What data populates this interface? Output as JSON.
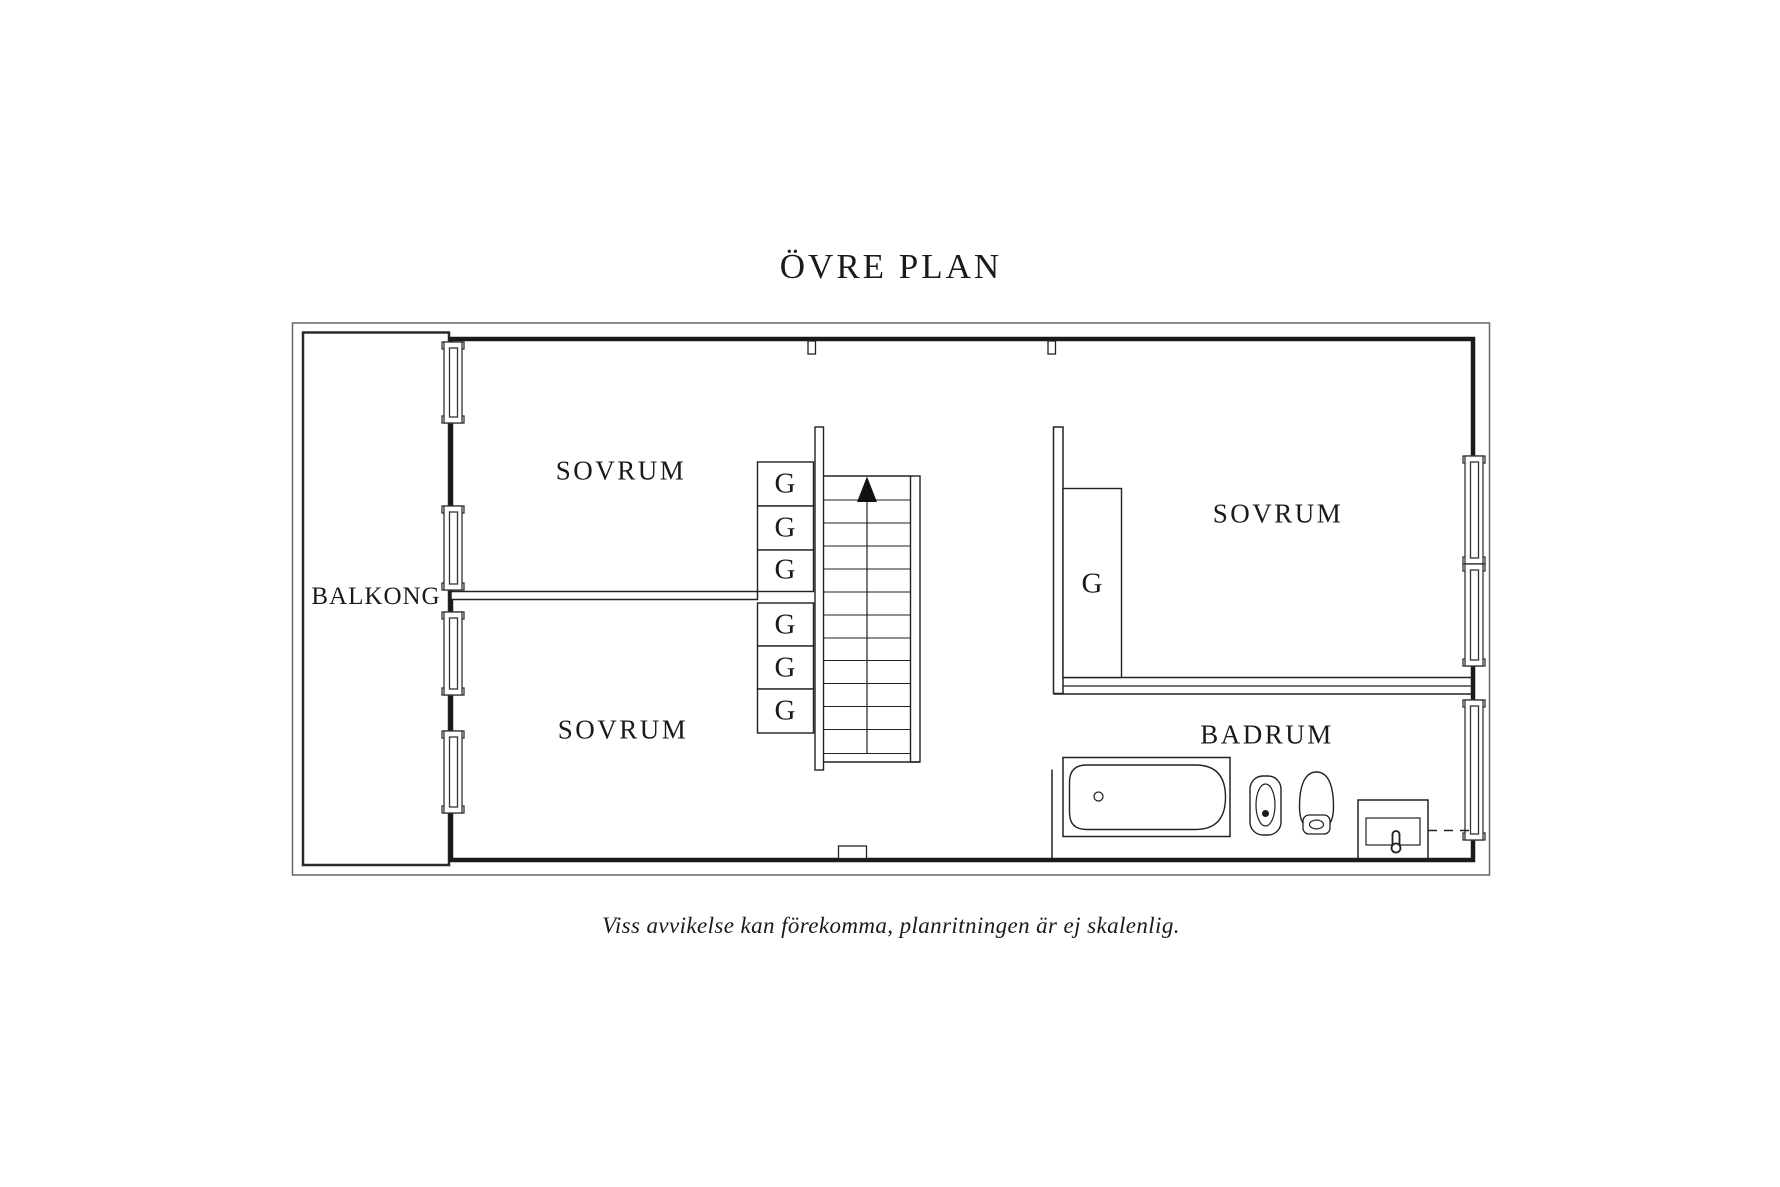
{
  "title": "ÖVRE PLAN",
  "caption": "Viss avvikelse kan förekomma, planritningen är ej skalenlig.",
  "rooms": {
    "balcony": "BALKONG",
    "bedroom_top_left": "SOVRUM",
    "bedroom_bottom_left": "SOVRUM",
    "bedroom_right": "SOVRUM",
    "bathroom": "BADRUM"
  },
  "wardrobes": {
    "label": "G",
    "count": 7
  },
  "stairs": {
    "direction": "up"
  },
  "colors": {
    "background": "#ffffff",
    "wall": "#1a1a1a",
    "thin_line": "#666666",
    "text": "#1a1a1a"
  }
}
